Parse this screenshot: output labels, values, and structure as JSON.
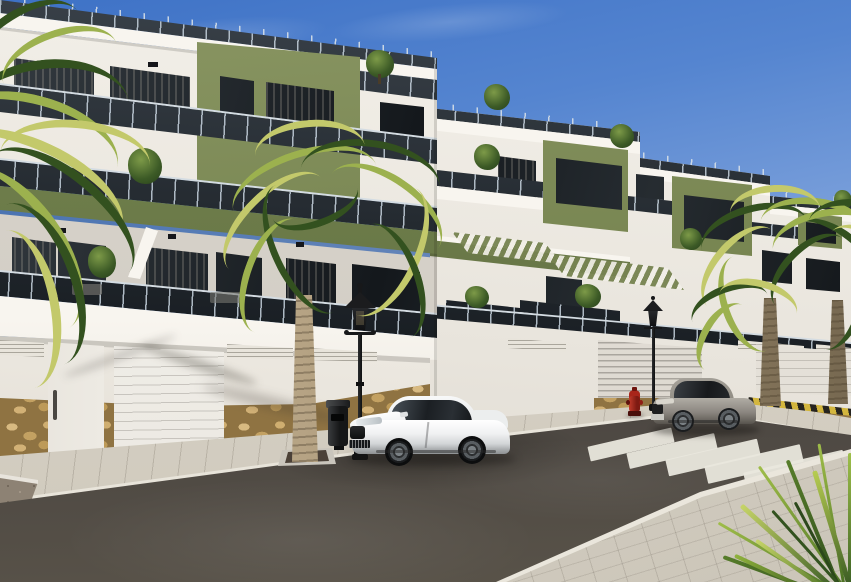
{
  "meta": {
    "domain": "natural-image",
    "subject": "3D architectural render of a modern white-and-olive apartment complex along a street with palm trees, parked cars and a zebra crossing",
    "visible_text": "none"
  },
  "scene": {
    "sky": {
      "top_color": "#3e72c6",
      "horizon_color": "#cddcf0",
      "clouds": "faint wisps upper left"
    },
    "buildings": {
      "left_block": {
        "style": "three-storey townhouses, white render with olive-green accent tower and fascia bands",
        "features": [
          "roof terrace with glass railing",
          "dark glazed windows",
          "glass balcony balustrades",
          "olive pergola fascia",
          "garage street wall with two white doors",
          "louvered vents",
          "natural stone base"
        ]
      },
      "right_block": {
        "style": "stepped terraced block receding right, white with olive-green towers",
        "features": [
          "roof terraces with glass railings",
          "rooftop shrubs",
          "olive slatted pergolas",
          "street wall with vented garage doors",
          "stone base at corner"
        ]
      },
      "facade_white": "#f2efe9",
      "facade_olive": "#7e8b58",
      "glass_dark": "#1c2125"
    },
    "street": {
      "road_color": "#45413d",
      "sidewalk_color": "#d8d3c8",
      "crosswalk": {
        "stripes": 7,
        "color": "#e9e7dd"
      },
      "curb_marking": {
        "pattern": "yellow-black diagonal",
        "yellow": "#d3b63e",
        "black": "#26241f"
      },
      "planters": [
        "gravel bed lower-left corner",
        "palm planter at centre kerb"
      ]
    },
    "vehicles": [
      {
        "name": "white-coupe",
        "description": "white sports coupe parked facing left",
        "color": "#f2f3f3"
      },
      {
        "name": "gray-coupe",
        "description": "grey coupe parked further right facing left",
        "color": "#8f8b84"
      }
    ],
    "street_furniture": [
      {
        "name": "street-lamp-near",
        "style": "black classic lantern post"
      },
      {
        "name": "street-lamp-far",
        "style": "black classic lantern post"
      },
      {
        "name": "litter-bin",
        "color": "#1e1f21"
      },
      {
        "name": "fire-hydrant",
        "color": "#a32219"
      }
    ],
    "vegetation": [
      {
        "name": "palm-left-edge",
        "type": "palm fronds overhanging from left"
      },
      {
        "name": "palm-center",
        "type": "tall palm with trunk at kerb"
      },
      {
        "name": "palms-right",
        "type": "two palms in front of right block"
      },
      {
        "name": "spike-plant-bottom-right",
        "type": "fan palm leaves in foreground corner"
      },
      {
        "name": "rooftop-shrubs",
        "type": "small trees on roof terraces"
      }
    ]
  },
  "palette": {
    "sky_top": "#3e72c6",
    "sky_horizon": "#cddcf0",
    "facade_white": "#f2efe9",
    "facade_olive": "#7e8b58",
    "glass_dark": "#1c2125",
    "railing_post": "#c9d2da",
    "stone": "#c2a067",
    "road": "#45413d",
    "sidewalk": "#d8d3c8",
    "crosswalk_stripe": "#e9e7dd",
    "curb_yellow": "#d3b63e",
    "palm_green": "#5d7f35",
    "palm_trunk": "#b3a084",
    "car_white": "#f2f3f3",
    "car_gray": "#8f8b84",
    "lamp_black": "#17181a",
    "hydrant_red": "#a32219"
  }
}
